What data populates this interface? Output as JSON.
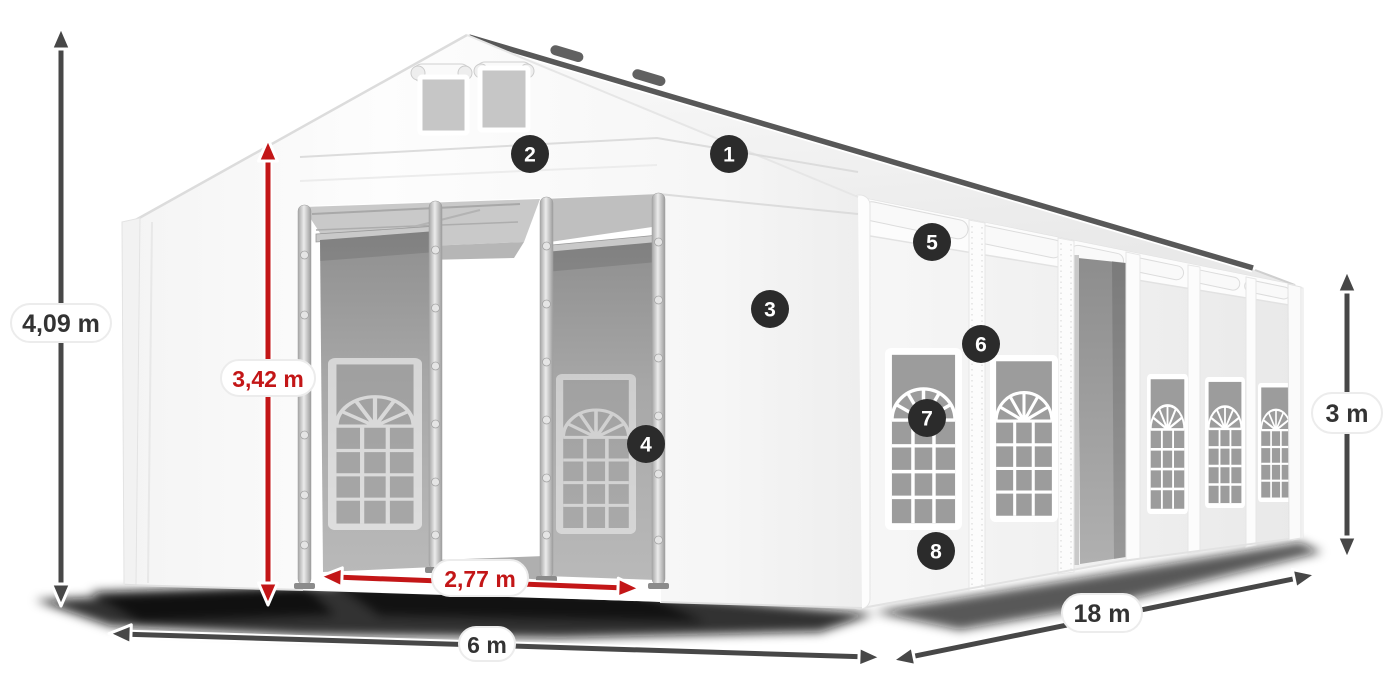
{
  "diagram": {
    "badges": [
      {
        "number": "1"
      },
      {
        "number": "2"
      },
      {
        "number": "3"
      },
      {
        "number": "4"
      },
      {
        "number": "5"
      },
      {
        "number": "6"
      },
      {
        "number": "7"
      },
      {
        "number": "8"
      }
    ],
    "dimensions": {
      "total_height": "4,09 m",
      "entrance_height": "3,42 m",
      "entrance_width": "2,77 m",
      "front_width": "6 m",
      "side_length": "18 m",
      "side_wall_height": "3 m"
    },
    "colors": {
      "dimension_arrow": "#474747",
      "highlight_red": "#c31617",
      "badge_background": "#2b2b2b",
      "badge_number": "#ffffff",
      "label_text": "#333333",
      "pill_background": "#ffffff"
    }
  }
}
